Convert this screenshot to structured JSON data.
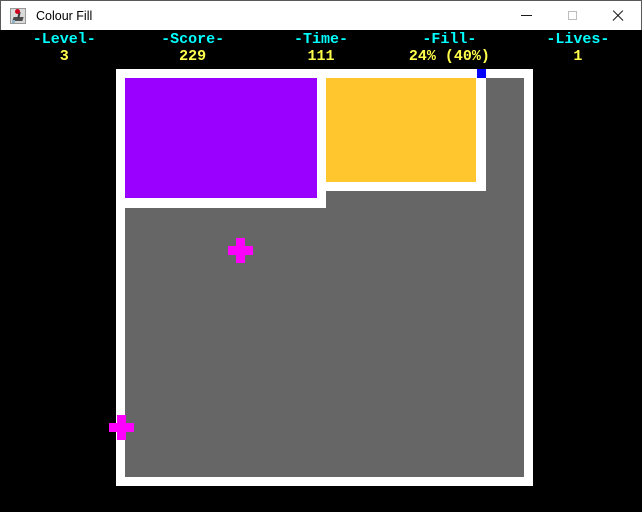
{
  "window": {
    "title": "Colour Fill",
    "icon": "joystick-app-icon",
    "controls": {
      "minimize": "minimize-icon",
      "maximize": "maximize-icon",
      "close": "close-icon"
    }
  },
  "hud": {
    "columns": [
      {
        "label": "-Level-",
        "value": "3"
      },
      {
        "label": "-Score-",
        "value": "229"
      },
      {
        "label": "-Time-",
        "value": "111"
      },
      {
        "label": "-Fill-",
        "value": "24% (40%)"
      },
      {
        "label": "-Lives-",
        "value": "1"
      }
    ]
  },
  "game": {
    "colors": {
      "background": "#000000",
      "frame": "#FFFFFF",
      "unfilled": "#666666",
      "fill_purple": "#9900FF",
      "fill_yellow": "#FFC62E",
      "player": "#0000FF",
      "enemy": "#FF00FF",
      "hud_label": "#00FFFF",
      "hud_value": "#FFFF4C"
    },
    "field": {
      "x": 116,
      "y": 39,
      "size": 417,
      "border": 9
    },
    "rects": [
      {
        "name": "filled-region-purple",
        "x": 9,
        "y": 9,
        "w": 192,
        "h": 120,
        "colorKey": "fill_purple"
      },
      {
        "name": "filled-region-yellow",
        "x": 210,
        "y": 9,
        "w": 150,
        "h": 104,
        "colorKey": "fill_yellow"
      },
      {
        "name": "wall-vertical-left",
        "x": 201,
        "y": 9,
        "w": 9,
        "h": 130,
        "colorKey": "frame"
      },
      {
        "name": "wall-horizontal-left",
        "x": 9,
        "y": 129,
        "w": 192,
        "h": 10,
        "colorKey": "frame"
      },
      {
        "name": "wall-horizontal-right",
        "x": 210,
        "y": 113,
        "w": 160,
        "h": 9,
        "colorKey": "frame"
      },
      {
        "name": "wall-vertical-right",
        "x": 360,
        "y": 9,
        "w": 10,
        "h": 113,
        "colorKey": "frame"
      },
      {
        "name": "player-marker",
        "x": 361,
        "y": 0,
        "w": 9,
        "h": 9,
        "colorKey": "player"
      }
    ],
    "enemies": [
      {
        "name": "enemy-cross-field",
        "cx": 124,
        "cy": 181
      },
      {
        "name": "enemy-cross-border",
        "cx": 5,
        "cy": 358
      }
    ],
    "enemy_size": 25,
    "enemy_arm": 9
  }
}
